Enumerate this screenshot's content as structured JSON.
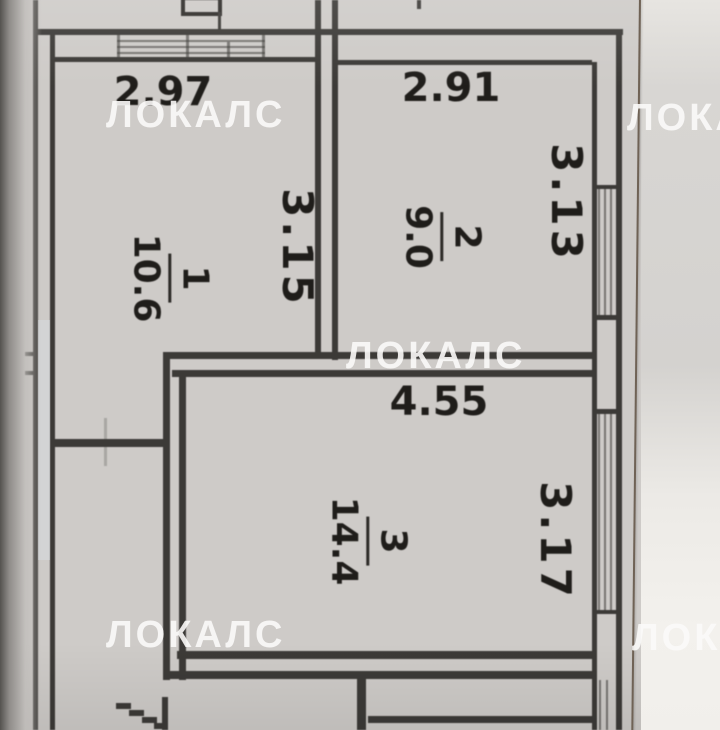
{
  "document": {
    "kind": "apartment floor plan photo",
    "paper_color": "#cecbc8",
    "line_color": "#3c3a37",
    "watermark_color": "#fbfaf8"
  },
  "watermark": {
    "text": "ЛОКАЛС"
  },
  "rooms": [
    {
      "number": "1",
      "area": "10.6",
      "top_dim": "2.97",
      "side_dim": "3.15"
    },
    {
      "number": "2",
      "area": "9.0",
      "top_dim": "2.91",
      "side_dim": "3.13"
    },
    {
      "number": "3",
      "area": "14.4",
      "top_dim": "4.55",
      "side_dim": "3.17"
    }
  ]
}
